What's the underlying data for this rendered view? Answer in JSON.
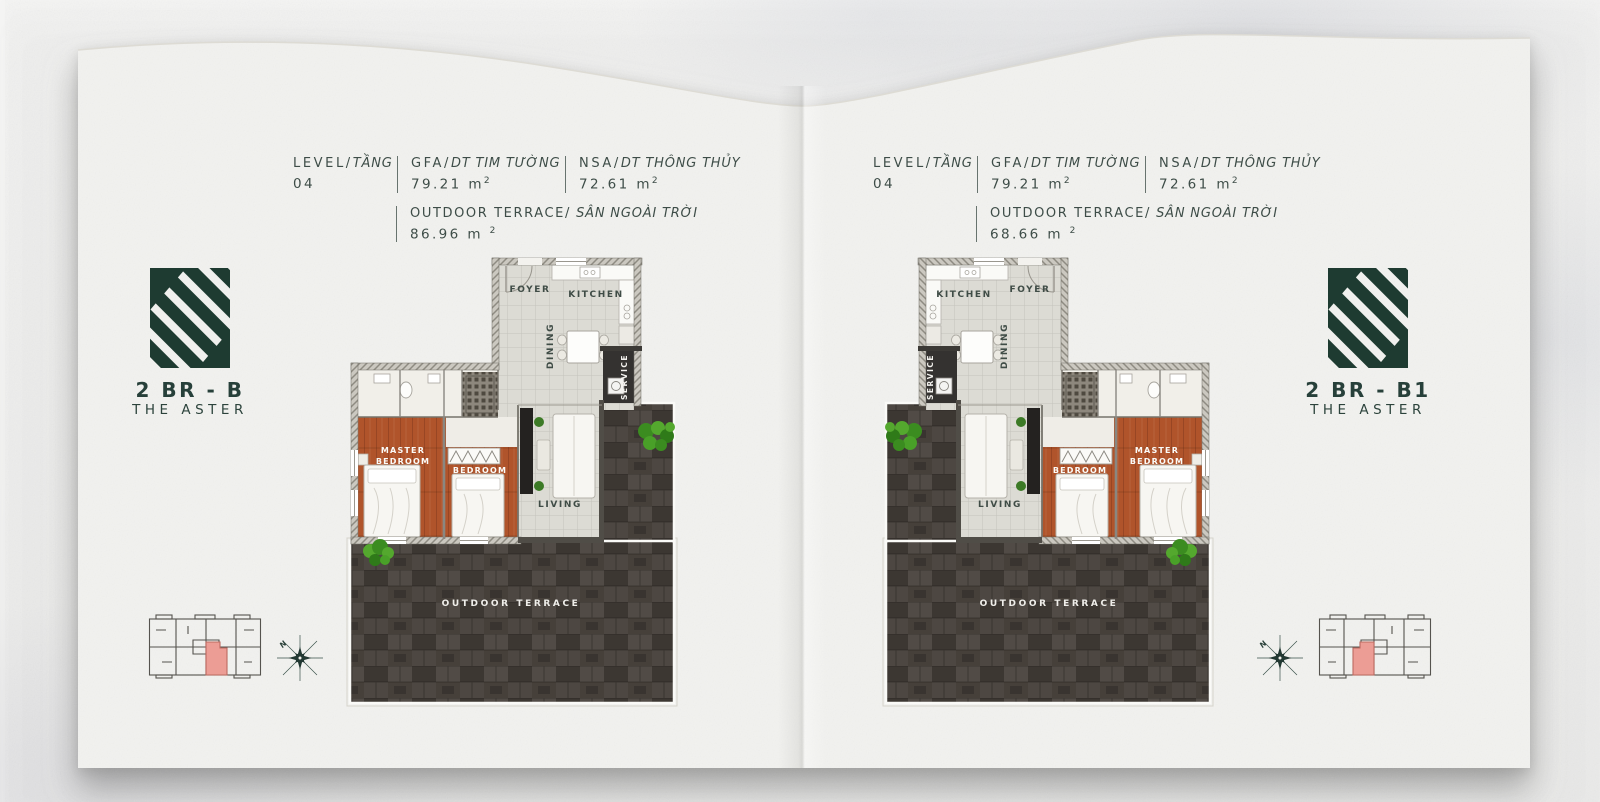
{
  "colors": {
    "brand_green": "#1e3b31",
    "wood_floor": "#b0542b",
    "terrace_stone": "#46403a",
    "unit_highlight": "#ec9d95"
  },
  "shared": {
    "sup2": "2",
    "compass_north": "N",
    "rooms": {
      "foyer": "FOYER",
      "kitchen": "KITCHEN",
      "dining": "DINING",
      "service": "SERVICE",
      "master_line1": "MASTER",
      "master_line2": "BEDROOM",
      "bedroom": "BEDROOM",
      "living": "LIVING",
      "terrace": "OUTDOOR TERRACE"
    }
  },
  "panels": [
    {
      "unit_code": "2 BR - B",
      "project": "THE ASTER",
      "stats": {
        "level_label": "LEVEL/",
        "level_label_vi": "TẦNG",
        "level_value": "04",
        "gfa_label": "GFA/",
        "gfa_label_vi": "DT TIM TƯỜNG",
        "gfa_value": "79.21 m",
        "nsa_label": "NSA/",
        "nsa_label_vi": "DT THÔNG THỦY",
        "nsa_value": "72.61 m",
        "terrace_label": "OUTDOOR TERRACE/",
        "terrace_label_vi": "SÂN NGOÀI TRỜI",
        "terrace_value": "86.96 m"
      }
    },
    {
      "unit_code": "2 BR - B1",
      "project": "THE ASTER",
      "stats": {
        "level_label": "LEVEL/",
        "level_label_vi": "TẦNG",
        "level_value": "04",
        "gfa_label": "GFA/",
        "gfa_label_vi": "DT TIM TƯỜNG",
        "gfa_value": "79.21 m",
        "nsa_label": "NSA/",
        "nsa_label_vi": "DT THÔNG THỦY",
        "nsa_value": "72.61 m",
        "terrace_label": "OUTDOOR TERRACE/",
        "terrace_label_vi": "SÂN NGOÀI TRỜI",
        "terrace_value": "68.66 m"
      }
    }
  ]
}
